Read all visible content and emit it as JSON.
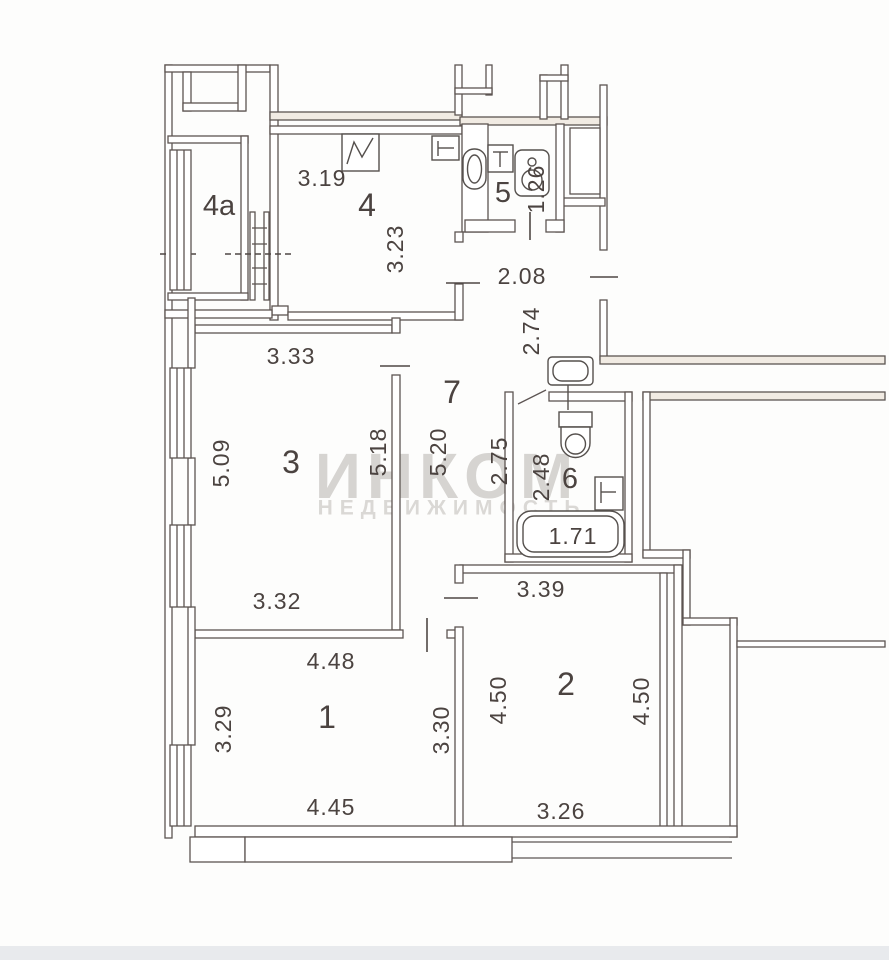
{
  "watermark": {
    "line1": "ИНКОМ",
    "line2": "НЕДВИЖИМОСТЬ"
  },
  "rooms": {
    "r4a": {
      "label": "4a"
    },
    "r4": {
      "label": "4",
      "dim_top": "3.19",
      "dim_right": "3.23"
    },
    "r5": {
      "label": "5",
      "dim_right": "1.26"
    },
    "hall": {
      "dim_width": "2.08",
      "dim_height": "2.74"
    },
    "r7": {
      "label": "7",
      "dim_left": "5.20",
      "dim_right": "2.75"
    },
    "r3": {
      "label": "3",
      "dim_top": "3.33",
      "dim_left": "5.09",
      "dim_right": "5.18",
      "dim_bottom": "3.32"
    },
    "r6": {
      "label": "6",
      "dim_left": "2.48",
      "tub_dim": "1.71"
    },
    "r1": {
      "label": "1",
      "dim_top": "4.48",
      "dim_left": "3.29",
      "dim_right": "3.30",
      "dim_bottom": "4.45"
    },
    "r2": {
      "label": "2",
      "dim_top": "3.39",
      "dim_left": "4.50",
      "dim_right": "4.50",
      "dim_bottom": "3.26"
    }
  }
}
